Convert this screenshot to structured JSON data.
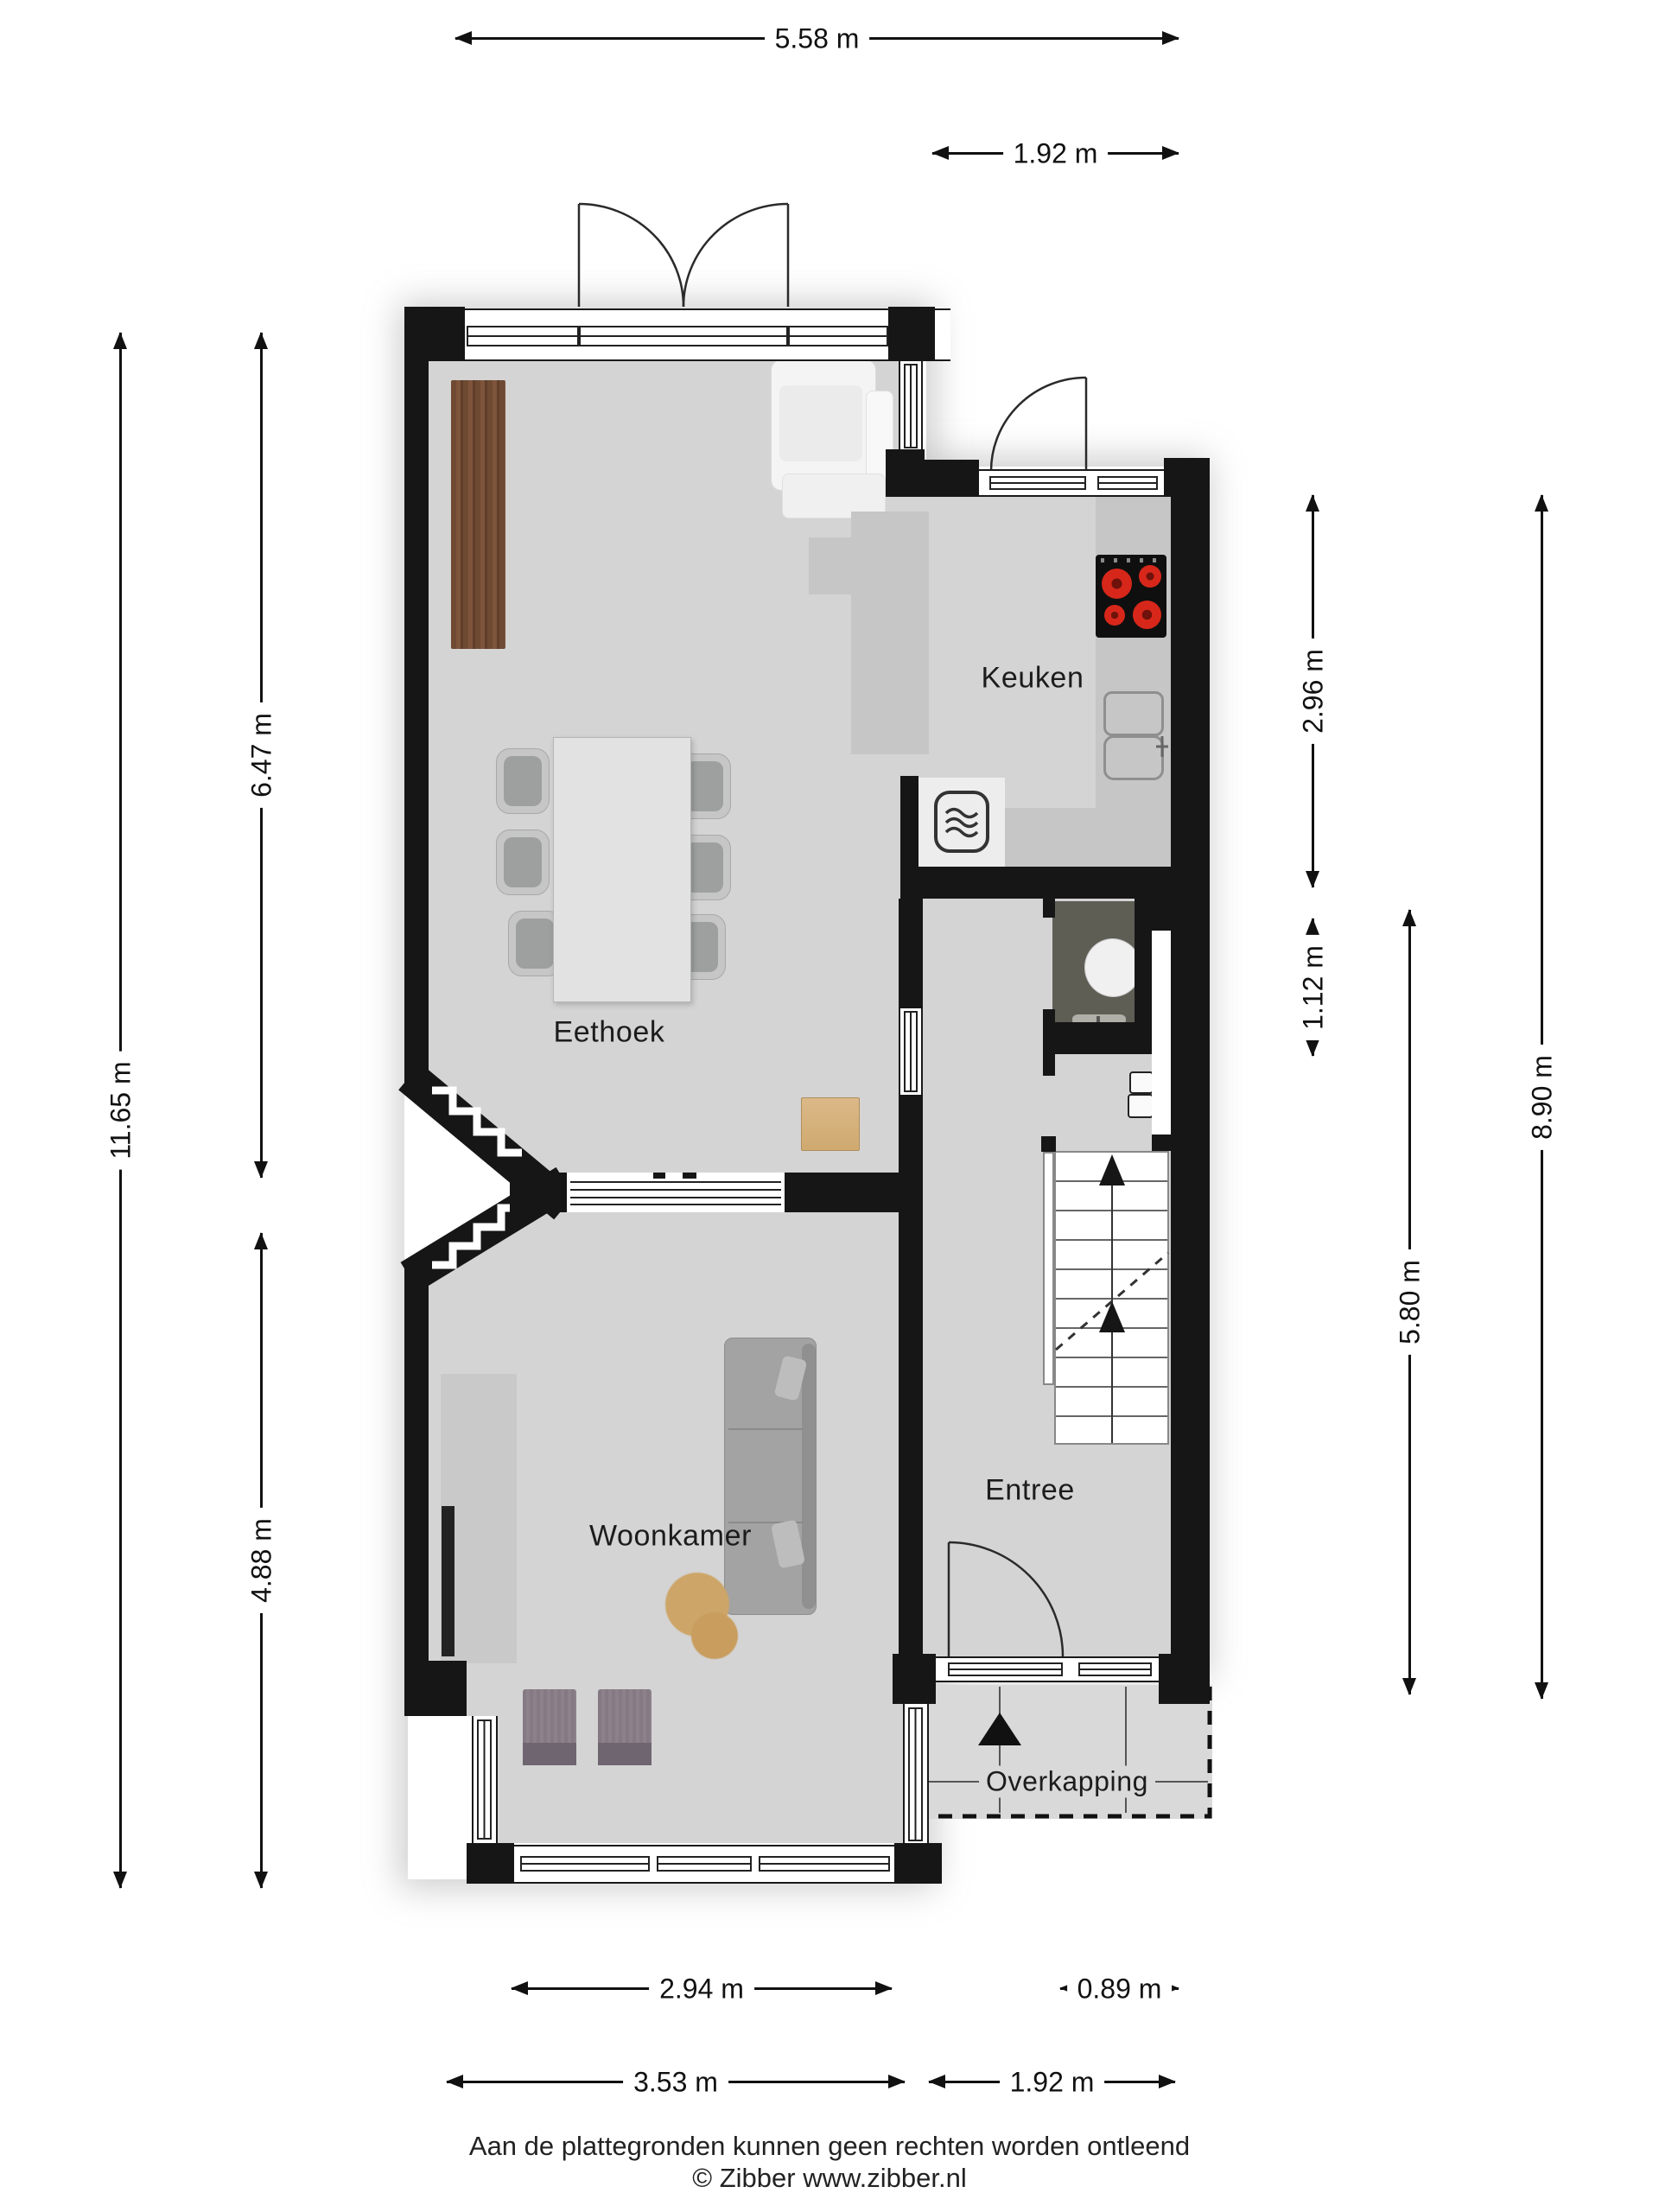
{
  "rooms": {
    "eethoek": {
      "label": "Eethoek"
    },
    "keuken": {
      "label": "Keuken"
    },
    "woonkamer": {
      "label": "Woonkamer"
    },
    "entree": {
      "label": "Entree"
    },
    "overkapping": {
      "label": "Overkapping"
    }
  },
  "dimensions": {
    "top_total": {
      "label": "5.58 m"
    },
    "top_kitchen": {
      "label": "1.92 m"
    },
    "left_total": {
      "label": "11.65 m"
    },
    "left_eethoek": {
      "label": "6.47 m"
    },
    "left_woonkamer": {
      "label": "4.88 m"
    },
    "right_kitchen": {
      "label": "2.96 m"
    },
    "right_toilet": {
      "label": "1.12 m"
    },
    "right_total": {
      "label": "8.90 m"
    },
    "right_entree": {
      "label": "5.80 m"
    },
    "bottom_bay": {
      "label": "2.94 m"
    },
    "bottom_door": {
      "label": "0.89 m"
    },
    "bottom_woonkamer": {
      "label": "3.53 m"
    },
    "bottom_entree": {
      "label": "1.92 m"
    }
  },
  "footer": {
    "disclaimer": "Aan de plattegronden kunnen geen rechten worden ontleend",
    "copyright": "© Zibber www.zibber.nl"
  },
  "colors": {
    "wall": "#161616",
    "floor": "#d4d4d4",
    "toilet_floor": "#5e5e55",
    "counter": "#c6c6c6",
    "wood_cabinet": "#6f4a33",
    "side_table": "#d9b583",
    "burner_red": "#d7271a",
    "rug": "#cda568",
    "overkapping_floor": "#d9d9d9"
  }
}
